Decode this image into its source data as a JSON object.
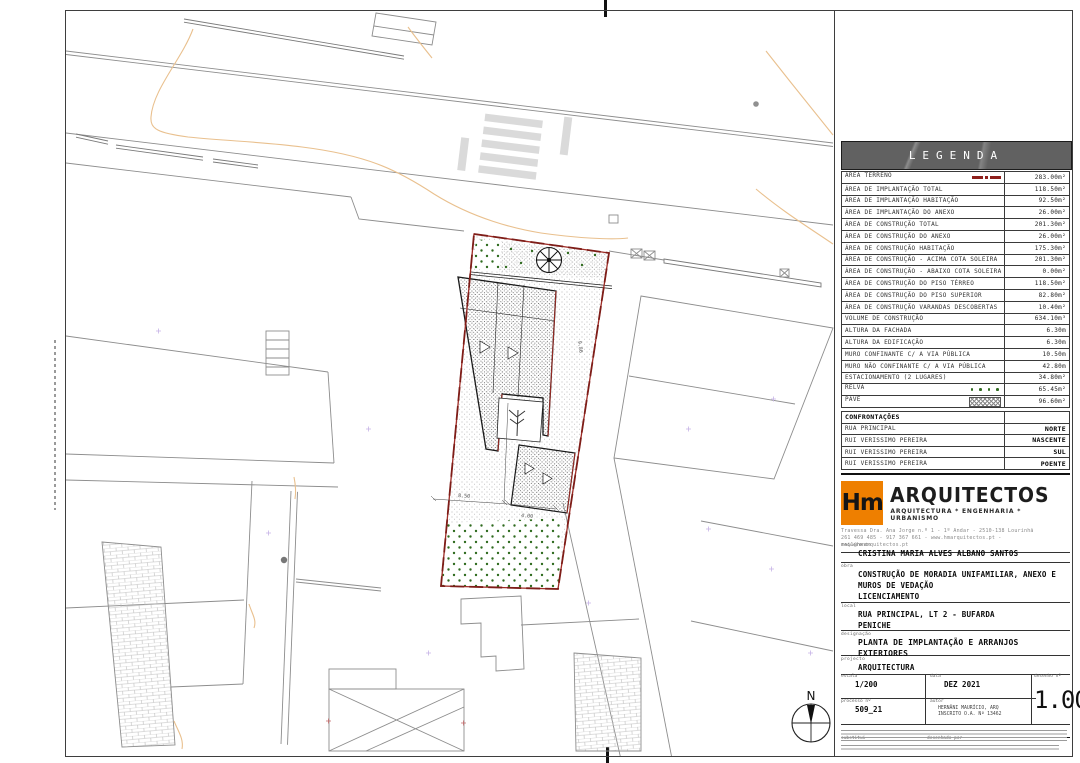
{
  "legend": {
    "title": "LEGENDA",
    "rows": [
      {
        "label": "ÁREA TERRENO",
        "value": "283.00m²",
        "symbol": "terreno"
      },
      {
        "label": "ÁREA DE IMPLANTAÇÃO TOTAL",
        "value": "118.50m²",
        "symbol": ""
      },
      {
        "label": "ÁREA DE IMPLANTAÇÃO HABITAÇÃO",
        "value": "92.50m²",
        "symbol": ""
      },
      {
        "label": "ÁREA DE IMPLANTAÇÃO DO ANEXO",
        "value": "26.00m²",
        "symbol": ""
      },
      {
        "label": "ÁREA DE CONSTRUÇÃO TOTAL",
        "value": "201.30m²",
        "symbol": ""
      },
      {
        "label": "ÁREA DE CONSTRUÇÃO DO ANEXO",
        "value": "26.00m²",
        "symbol": ""
      },
      {
        "label": "ÁREA DE CONSTRUÇÃO HABITAÇÃO",
        "value": "175.30m²",
        "symbol": ""
      },
      {
        "label": "ÁREA DE CONSTRUÇÃO - ACIMA COTA SOLEIRA",
        "value": "201.30m²",
        "symbol": ""
      },
      {
        "label": "ÁREA DE CONSTRUÇÃO - ABAIXO COTA SOLEIRA",
        "value": "0.00m²",
        "symbol": ""
      },
      {
        "label": "ÁREA DE CONSTRUÇÃO DO PISO TÉRREO",
        "value": "118.50m²",
        "symbol": ""
      },
      {
        "label": "ÁREA DE CONSTRUÇÃO DO PISO SUPERIOR",
        "value": "82.80m²",
        "symbol": ""
      },
      {
        "label": "ÁREA DE CONSTRUÇÃO VARANDAS DESCOBERTAS",
        "value": "10.40m²",
        "symbol": ""
      },
      {
        "label": "VOLUME DE CONSTRUÇÃO",
        "value": "634.10m³",
        "symbol": ""
      },
      {
        "label": "ALTURA DA FACHADA",
        "value": "6.30m",
        "symbol": ""
      },
      {
        "label": "ALTURA DA EDIFICAÇÃO",
        "value": "6.30m",
        "symbol": ""
      },
      {
        "label": "MURO CONFINANTE C/ A VIA PÚBLICA",
        "value": "10.50m",
        "symbol": ""
      },
      {
        "label": "MURO NÃO CONFINANTE C/ A VIA PÚBLICA",
        "value": "42.80m",
        "symbol": ""
      },
      {
        "label": "ESTACIONAMENTO (2 LUGARES)",
        "value": "34.80m²",
        "symbol": ""
      },
      {
        "label": "RELVA",
        "value": "65.45m²",
        "symbol": "relva"
      },
      {
        "label": "PAVÊ",
        "value": "96.60m²",
        "symbol": "pave"
      }
    ]
  },
  "confrontacoes": {
    "header": "CONFRONTAÇÕES",
    "rows": [
      {
        "label": "RUA PRINCIPAL",
        "value": "NORTE"
      },
      {
        "label": "RUI VERISSIMO PEREIRA",
        "value": "NASCENTE"
      },
      {
        "label": "RUI VERISSIMO PEREIRA",
        "value": "SUL"
      },
      {
        "label": "RUI VERISSIMO PEREIRA",
        "value": "POENTE"
      }
    ]
  },
  "firm": {
    "logo_text": "Hm",
    "name": "ARQUITECTOS",
    "tagline": "ARQUITECTURA * ENGENHARIA * URBANISMO",
    "address_line1": "Travessa Dra. Ana Jorge n.º 1 - 1º Andar - 2510-138 Lourinhã",
    "address_line2": "261 469 485 - 917 367 661 - www.hmarquitectos.pt - mail@hmarquitectos.pt"
  },
  "titleblock": {
    "requerente_label": "requerente",
    "requerente": "CRISTINA MARIA ALVES ALBANO SANTOS",
    "obra_label": "obra",
    "obra_line1": "CONSTRUÇÃO DE MORADIA UNIFAMILIAR, ANEXO E",
    "obra_line2": "MUROS DE VEDAÇÃO",
    "obra_line3": "LICENCIAMENTO",
    "local_label": "local",
    "local_line1": "RUA PRINCIPAL, LT 2 - BUFARDA",
    "local_line2": "PENICHE",
    "designacao_label": "designação",
    "designacao": "PLANTA DE IMPLANTAÇÃO E ARRANJOS EXTERIORES",
    "projecto_label": "projecto",
    "projecto": "ARQUITECTURA",
    "escala_label": "escala",
    "escala": "1/200",
    "data_label": "data",
    "data": "DEZ 2021",
    "desenho_label": "desenho nº",
    "desenho": "1.00",
    "processo_label": "processo nº",
    "processo": "509_21",
    "autor_label": "autor",
    "autor_line1": "HERNÂNI MAURÍCIO, ARQ",
    "autor_line2": "INSCRITO O.A. Nº 13462",
    "substitui_label": "substitui",
    "desenhado_label": "desenhado por"
  },
  "plan": {
    "north_label": "N",
    "dimensions": {
      "d1": "9.86",
      "d2": "8.50",
      "d3": "4.00"
    }
  },
  "colors": {
    "boundary_red": "#9e2b25",
    "grass_green": "#2f6b1f",
    "contour_orange": "#e9c08e",
    "logo_orange": "#ee7f00",
    "legend_bar_gray": "#616161"
  }
}
